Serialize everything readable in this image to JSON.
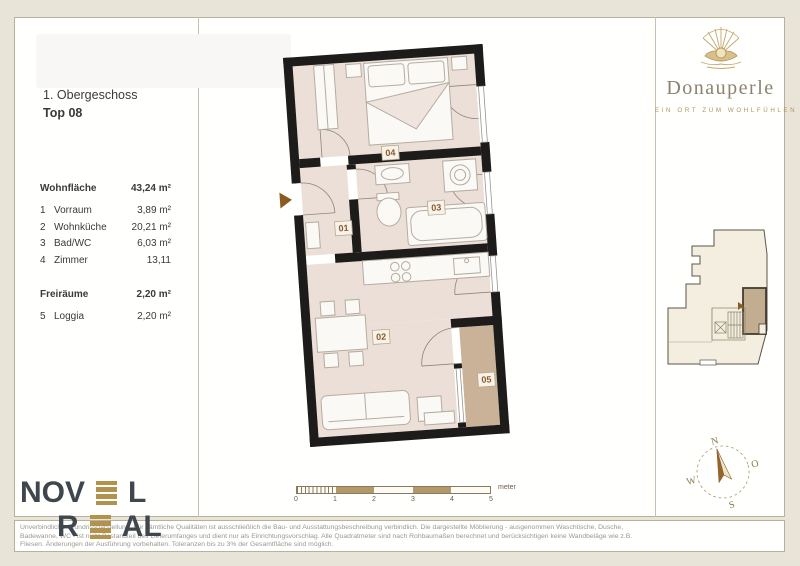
{
  "header": {
    "floor": "1. Obergeschoss",
    "unit": "Top 08"
  },
  "area_table": {
    "main_label": "Wohnfläche",
    "main_value": "43,24 m²",
    "rows": [
      {
        "no": "1",
        "name": "Vorraum",
        "value": "3,89 m²"
      },
      {
        "no": "2",
        "name": "Wohnküche",
        "value": "20,21 m²"
      },
      {
        "no": "3",
        "name": "Bad/WC",
        "value": "6,03 m²"
      },
      {
        "no": "4",
        "name": "Zimmer",
        "value": "13,11"
      }
    ],
    "free_label": "Freiräume",
    "free_value": "2,20 m²",
    "free_rows": [
      {
        "no": "5",
        "name": "Loggia",
        "value": "2,20 m²"
      }
    ]
  },
  "brand": {
    "name": "Donauperle",
    "tagline": "EIN ORT ZUM WOHLFÜHLEN"
  },
  "plan": {
    "labels": {
      "hall": "01",
      "living": "02",
      "bath": "03",
      "bedroom": "04",
      "loggia": "05"
    }
  },
  "scalebar": {
    "ticks": [
      "0",
      "1",
      "2",
      "3",
      "4",
      "5"
    ],
    "unit": "meter"
  },
  "compass": {
    "north": "N",
    "east": "O",
    "south": "S",
    "west": "W"
  },
  "novel_logo": {
    "part1": "NOV",
    "part1_end": "L",
    "part2": "R",
    "part2_end": "AL"
  },
  "disclaimer": {
    "line1": "Unverbindliche Grundrissdarstellung. Für sämtliche Qualitäten ist ausschließlich die Bau- und Ausstattungsbeschreibung verbindlich. Die dargestellte Möblierung - ausgenommen Waschtische, Dusche,",
    "line2": "Badewanne, WC - ist nicht Bestandteil des Lieferumfanges und dient nur als Einrichtungsvorschlag. Alle Quadratmeter sind nach Rohbaumaßen berechnet und berücksichtigen keine Wandbeläge wie z.B.",
    "line3": "Fliesen. Änderungen der Ausführung vorbehalten. Toleranzen bis zu 3% der Gesamtfläche sind möglich."
  },
  "colors": {
    "wall": "#1d1c1a",
    "floor": "#ecdfd7",
    "loggia_floor": "#c9b298",
    "accent_gold": "#b3924e",
    "room_label_text": "#8a5a28",
    "page_margin": "#e9e4d8"
  }
}
